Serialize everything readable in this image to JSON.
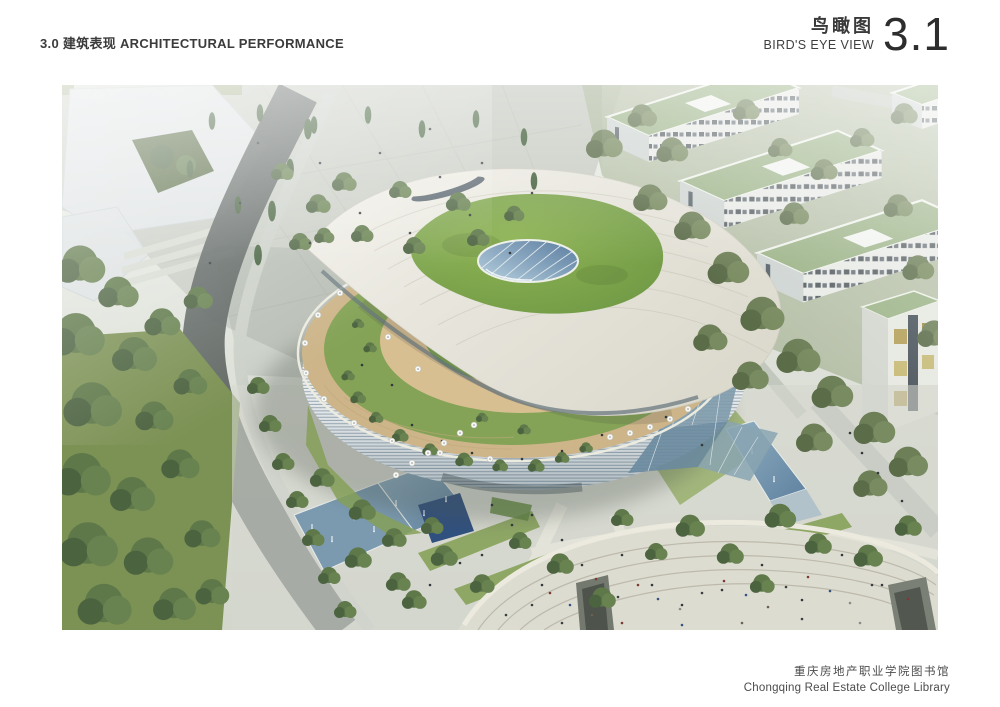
{
  "header": {
    "section": "3.0 建筑表现 ARCHITECTURAL PERFORMANCE",
    "title_cn": "鸟瞰图",
    "title_en": "BIRD'S EYE VIEW",
    "page_no": "3.1"
  },
  "footer": {
    "project_cn": "重庆房地产职业学院图书馆",
    "project_en": "Chongqing Real Estate College Library"
  },
  "figure": {
    "alt": "Aerial bird's-eye rendering of the Chongqing Real Estate College Library: an organic leaf-shaped building with a sweeping white roof canopy, green roof garden with elliptical skylight, wooden terrace with white cafe umbrellas, louvered glass facade, surrounded by campus plazas, dormitory blocks with green roofs, dense trees, water features with fountains and a curved amphitheater filled with people.",
    "palette": {
      "paper": "#ffffff",
      "ink": "#3a3a3a",
      "canopy": "#e9e7dd",
      "roof_lawn": "#7fa64d",
      "terrace_deck": "#cdb589",
      "facade_louver_gap": "#97a6b0",
      "glass": "#7d99ab",
      "water": "#7b9ab0",
      "water_deep": "#30507f",
      "plaza": "#d3d6cc",
      "plaza_dark_road": "#59615d",
      "forest": "#50673f",
      "campus_roof": "#9db489",
      "amphitheater": "#dddcd1"
    }
  }
}
